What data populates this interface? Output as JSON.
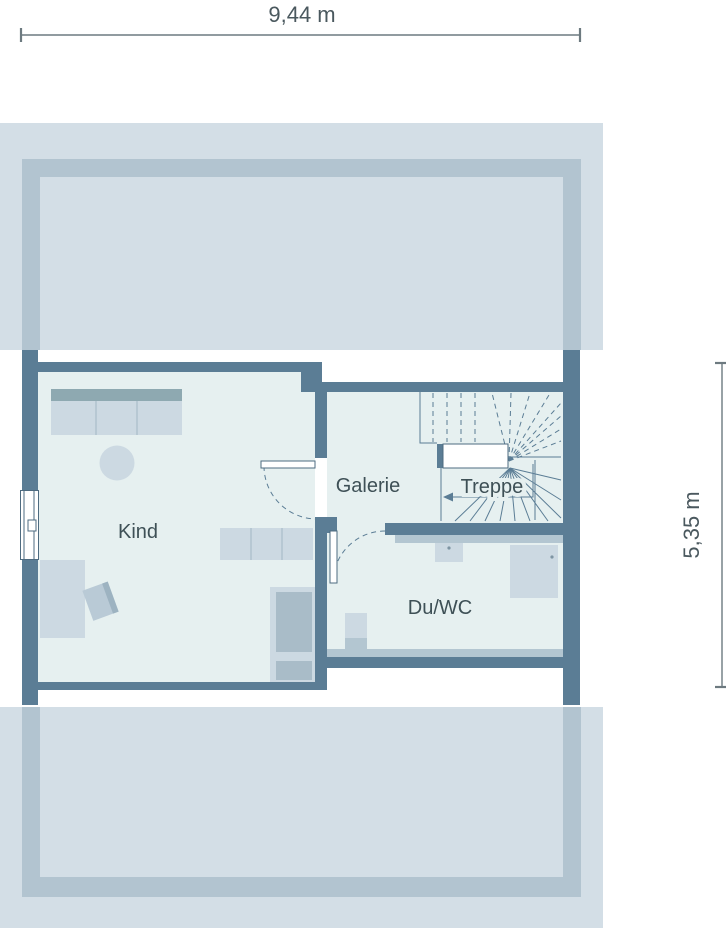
{
  "plan": {
    "type": "floor-plan",
    "dimensions": {
      "width_label": "9,44 m",
      "depth_label": "5,35 m"
    },
    "rooms": {
      "kind": {
        "label": "Kind"
      },
      "galerie": {
        "label": "Galerie"
      },
      "treppe": {
        "label": "Treppe"
      },
      "duwc": {
        "label": "Du/WC"
      }
    }
  },
  "colors": {
    "wall": "#5b7d95",
    "room_fill": "#e6f0f0",
    "band": "#d3dee6",
    "band_outline": "#b2c4d0",
    "furniture_light": "#ccd9e2",
    "furniture_medium": "#a9bcc8",
    "wardrobe_top": "#8ea9b1",
    "medium_strip": "#b3c6d1",
    "chair": "#b9cad6",
    "chair_edge": "#9db3c1",
    "stair_line": "#5b7d95",
    "dimension_line": "#6d7a80",
    "label_text": "#3e5056",
    "white": "#ffffff"
  }
}
